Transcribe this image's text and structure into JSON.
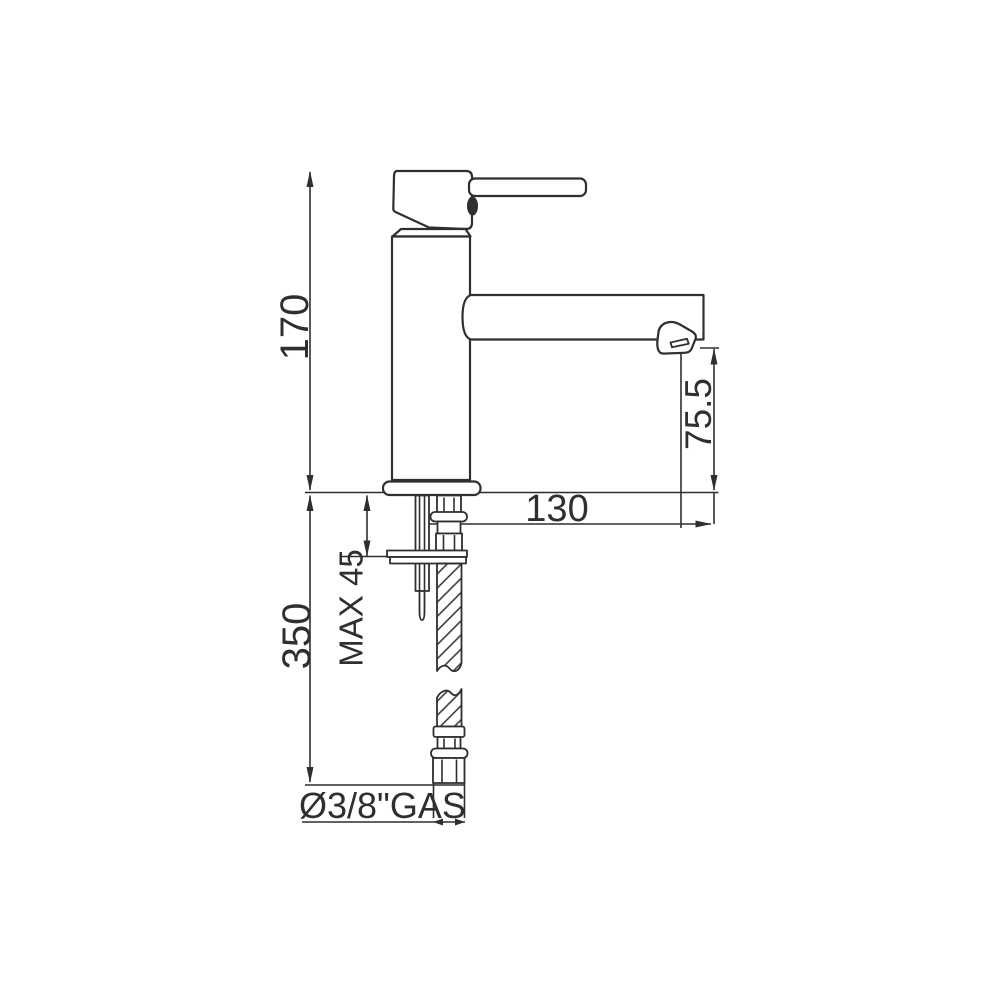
{
  "drawing": {
    "type": "technical-dimension-drawing",
    "subject": "single-lever basin mixer tap, side elevation",
    "colors": {
      "line": "#2f2f2f",
      "background": "#ffffff"
    },
    "dimensions": [
      {
        "id": "overall-height",
        "value": "170",
        "orientation": "vertical"
      },
      {
        "id": "hose-length",
        "value": "350",
        "orientation": "vertical"
      },
      {
        "id": "max-deck-thickness",
        "value": "MAX 45",
        "orientation": "vertical"
      },
      {
        "id": "spout-reach",
        "value": "130",
        "orientation": "horizontal"
      },
      {
        "id": "spout-outlet-height",
        "value": "75.5",
        "orientation": "vertical"
      },
      {
        "id": "connection-thread",
        "value": "Ø3/8\"GAS",
        "orientation": "horizontal"
      }
    ]
  }
}
